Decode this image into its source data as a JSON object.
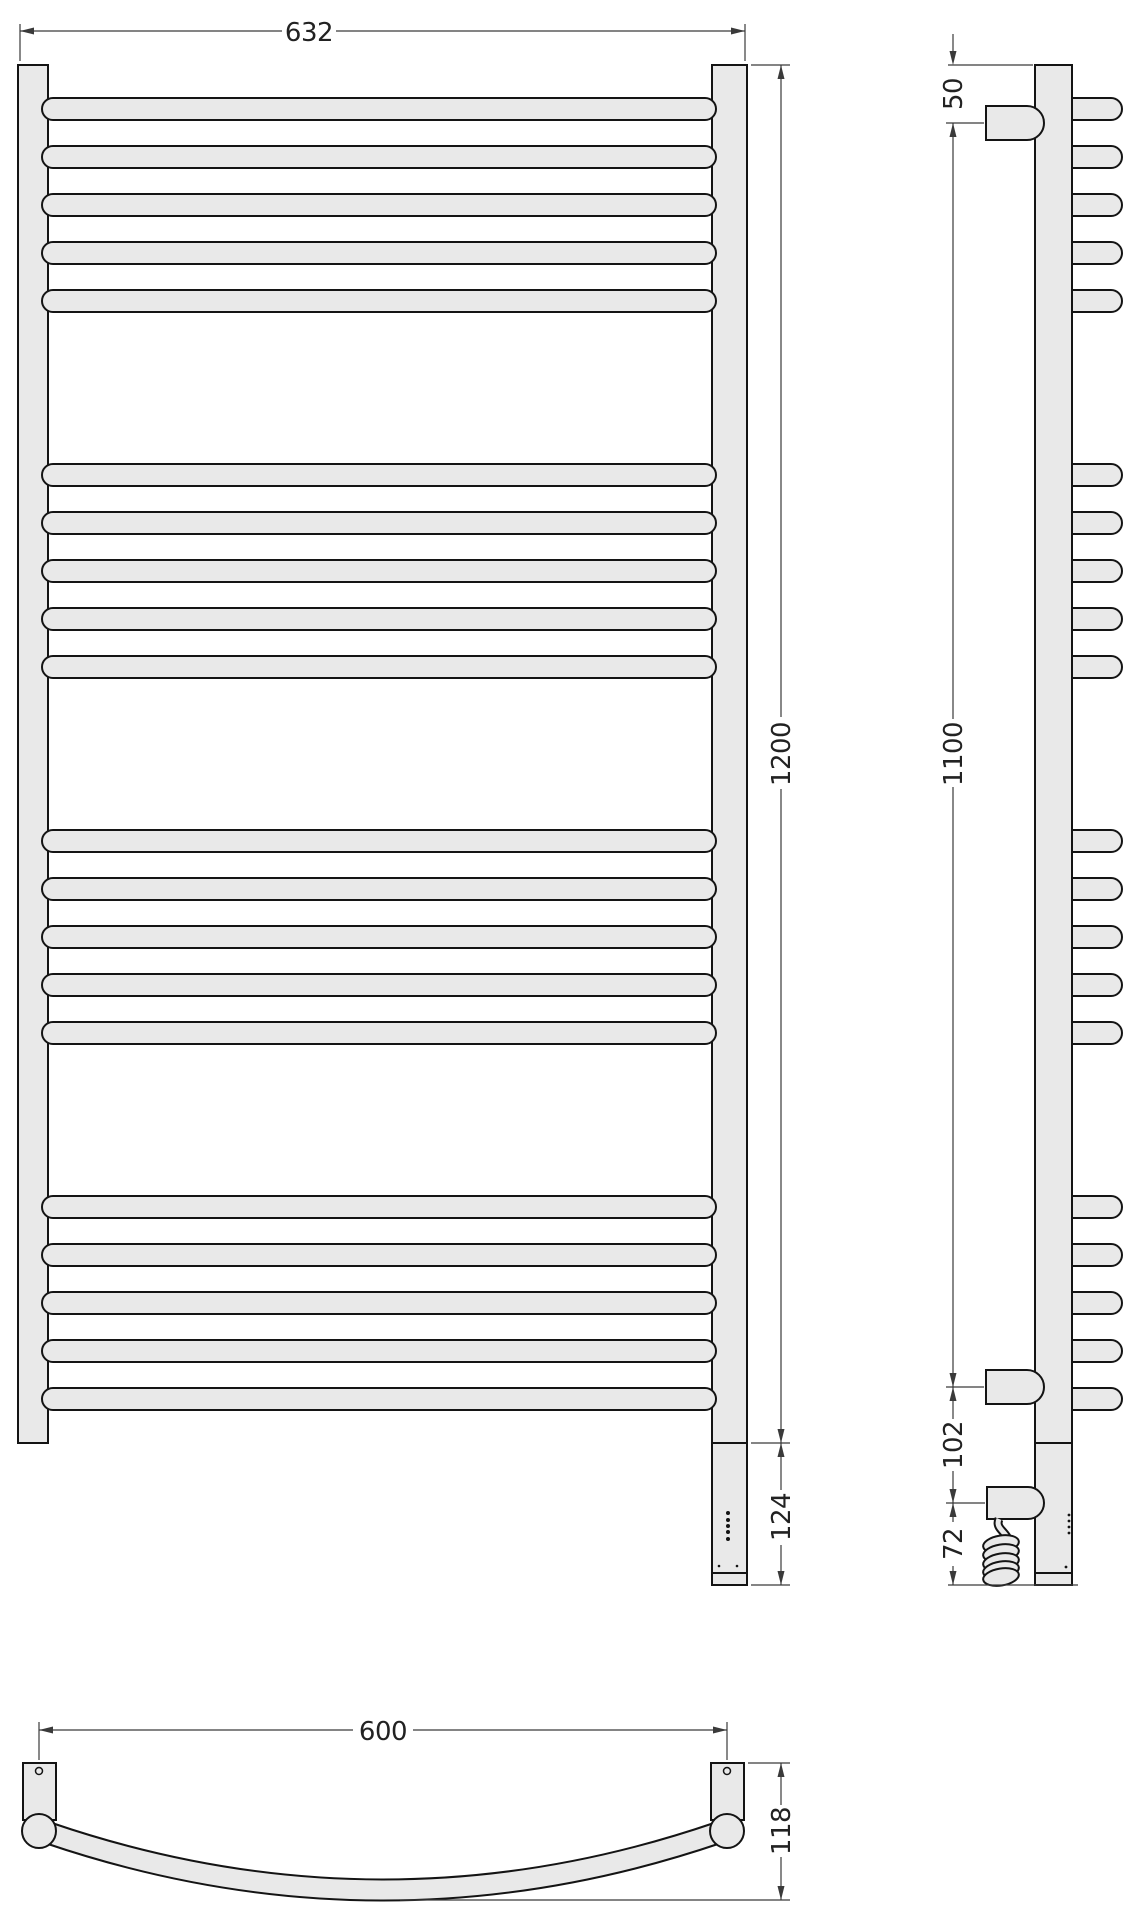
{
  "drawing": {
    "type": "technical-drawing",
    "subject": "ladder towel rail with electric heating element",
    "views": [
      "front",
      "side",
      "bottom"
    ],
    "colors": {
      "part_fill": "#e9e9e9",
      "outline": "#141414",
      "dimension": "#3a3a3a"
    },
    "labels": {
      "front_width": "632",
      "front_height": "1200",
      "element_length": "124",
      "side_top_offset": "50",
      "side_mount_span": "1100",
      "side_block_offset": "102",
      "side_cable_offset": "72",
      "bottom_mount_span": "600",
      "bottom_depth": "118"
    },
    "dimensions_mm": {
      "overall_width": 632,
      "overall_height": 1200,
      "element_extension": 124,
      "top_to_bracket": 50,
      "bracket_span": 1100,
      "bracket_to_power_block": 102,
      "power_block_to_floor": 72,
      "wall_fixing_span": 600,
      "depth": 118
    },
    "front": {
      "bar_x": 42,
      "bar_w": 674,
      "bar_h": 22,
      "bar_rx": 11,
      "bar_tops": [
        98,
        146,
        194,
        242,
        290,
        464,
        512,
        560,
        608,
        656,
        830,
        878,
        926,
        974,
        1022,
        1196,
        1244,
        1292,
        1340,
        1388
      ],
      "bars_per_group": 5,
      "group_count": 4
    },
    "side": {
      "tab_x": 1048,
      "tab_w": 74,
      "tab_h": 22,
      "tab_rx": 11,
      "tab_tops": [
        98,
        146,
        194,
        242,
        290,
        464,
        512,
        560,
        608,
        656,
        830,
        878,
        926,
        974,
        1022,
        1196,
        1244,
        1292,
        1340,
        1388
      ]
    }
  }
}
